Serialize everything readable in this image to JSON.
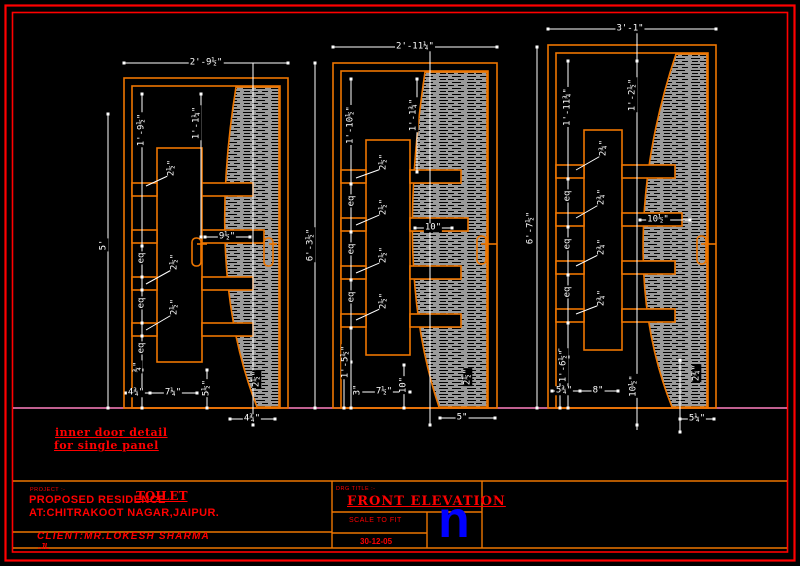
{
  "sheet": {
    "type": "CAD elevation drawing",
    "note": {
      "line1": "inner door detail",
      "line2": "for single panel"
    },
    "colors": {
      "background": "#000000",
      "border_red": "#ff0000",
      "frame_orange": "#ee7600",
      "dimension_white": "#ffffff",
      "hatch_gray": "#9a9a9a",
      "floor_pink": "#ff80c0",
      "text_red": "#ff0000",
      "logo_blue": "#0000ff"
    }
  },
  "doors": [
    {
      "name": "door elevation 1 (left)",
      "top_width": "2'-9½\"",
      "left_height": "5'",
      "right_height": "6'-3½\"",
      "stile_height": "1'-9½\"",
      "panel_top": "1'-1¼\"",
      "rail_thickness": [
        "2½\"",
        "2½\"",
        "2½\""
      ],
      "rail_length": "9½\"",
      "eq": [
        "eq",
        "eq",
        "eq"
      ],
      "bottom": {
        "stile": "¾\"",
        "a": "4¾\"",
        "b": "7¼\"",
        "c": "5½\"",
        "hatch": "2½\"",
        "under": "4¾\""
      }
    },
    {
      "name": "door elevation 2 (middle)",
      "top_width": "2'-11¼\"",
      "right_height": "6'-7½\"",
      "stile_height": "1'-10½\"",
      "panel_top": "1'-1¾\"",
      "rail_thickness": [
        "2½\"",
        "2½\"",
        "2½\"",
        "2½\""
      ],
      "rail_length": "10\"",
      "eq": [
        "eq",
        "eq",
        "eq"
      ],
      "bottom": {
        "a": "1'-5½\"",
        "b": "3\"",
        "c": "7½\"",
        "d": "10\"",
        "hatch": "2½\"",
        "under": "5\""
      }
    },
    {
      "name": "door elevation 3 (right)",
      "top_width": "3'-1\"",
      "stile_height": "1'-11¾\"",
      "panel_top": "1'-2½\"",
      "rail_thickness": [
        "2¾\"",
        "2¾\"",
        "2¾\"",
        "2¾\""
      ],
      "rail_length": "10½\"",
      "eq": [
        "eq",
        "eq",
        "eq"
      ],
      "bottom": {
        "a": "1'-6½\"",
        "b": "5¾\"",
        "c": "8\"",
        "d": "10½\"",
        "hatch": "2¾\"",
        "under": "5¼\""
      }
    }
  ],
  "title_block": {
    "project_label": "PROJECT :-",
    "project_line1": "PROPOSED RESIDENCE",
    "project_overlay": "TOILET",
    "project_line2": "AT:CHITRAKOOT NAGAR,JAIPUR.",
    "client": "CLIENT:MR.LOKESH SHARMA",
    "client_initials": ".JL",
    "drg_title_label": "DRG TITLE :-",
    "drg_title": "FRONT ELEVATION",
    "scale": "SCALE TO FIT",
    "date": "30-12-05",
    "logo": "n"
  }
}
